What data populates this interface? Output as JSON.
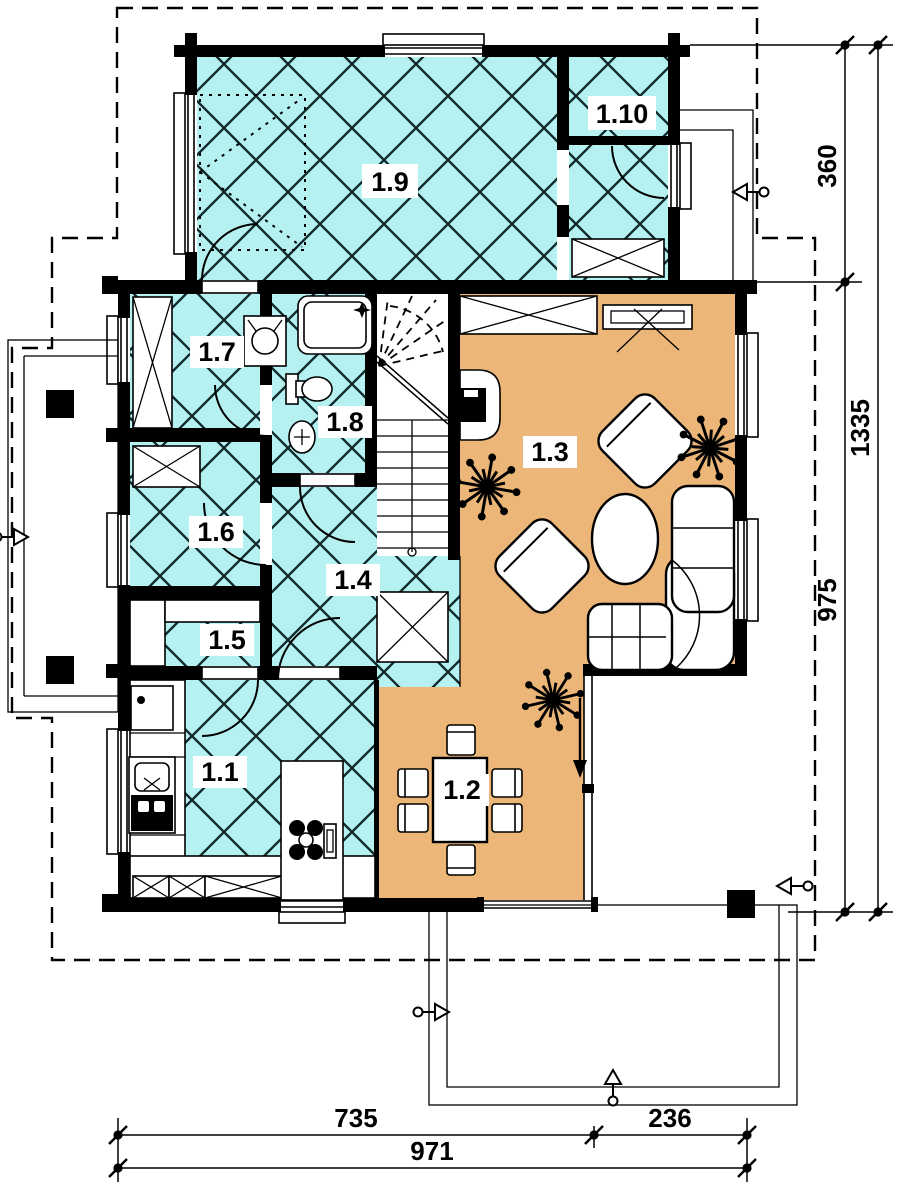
{
  "plan": {
    "type": "floor-plan",
    "floor_label": "ground floor"
  },
  "colors": {
    "tile_floor": "#b5f1f1",
    "wood_floor": "#ecb678",
    "wall": "#000000",
    "paper": "#ffffff",
    "hatch_line": "#10282a"
  },
  "rooms": [
    {
      "id": "1.1",
      "floor": "tile"
    },
    {
      "id": "1.2",
      "floor": "wood"
    },
    {
      "id": "1.3",
      "floor": "wood"
    },
    {
      "id": "1.4",
      "floor": "tile"
    },
    {
      "id": "1.5",
      "floor": "tile"
    },
    {
      "id": "1.6",
      "floor": "tile"
    },
    {
      "id": "1.7",
      "floor": "tile"
    },
    {
      "id": "1.8",
      "floor": "tile"
    },
    {
      "id": "1.9",
      "floor": "tile"
    },
    {
      "id": "1.10",
      "floor": "tile"
    }
  ],
  "dimensions": {
    "right_inner": [
      "360",
      "975"
    ],
    "right_outer": "1335",
    "bottom_inner": [
      "735",
      "236"
    ],
    "bottom_outer": "971"
  },
  "symbols": [
    "cross-hatch-tiled-floor",
    "solid-wood-floor",
    "wardrobe-cross-box",
    "door-swing-arc",
    "window-in-wall",
    "entry-arrow",
    "plant-starburst",
    "stair-winder",
    "fireplace",
    "corner-sofa",
    "armchair",
    "coffee-table",
    "dining-table-six-chairs",
    "kitchen-island-cooktop",
    "kitchen-sink",
    "shower",
    "toilet",
    "washbasin",
    "terrace-column",
    "roof-overhang-dashed"
  ]
}
